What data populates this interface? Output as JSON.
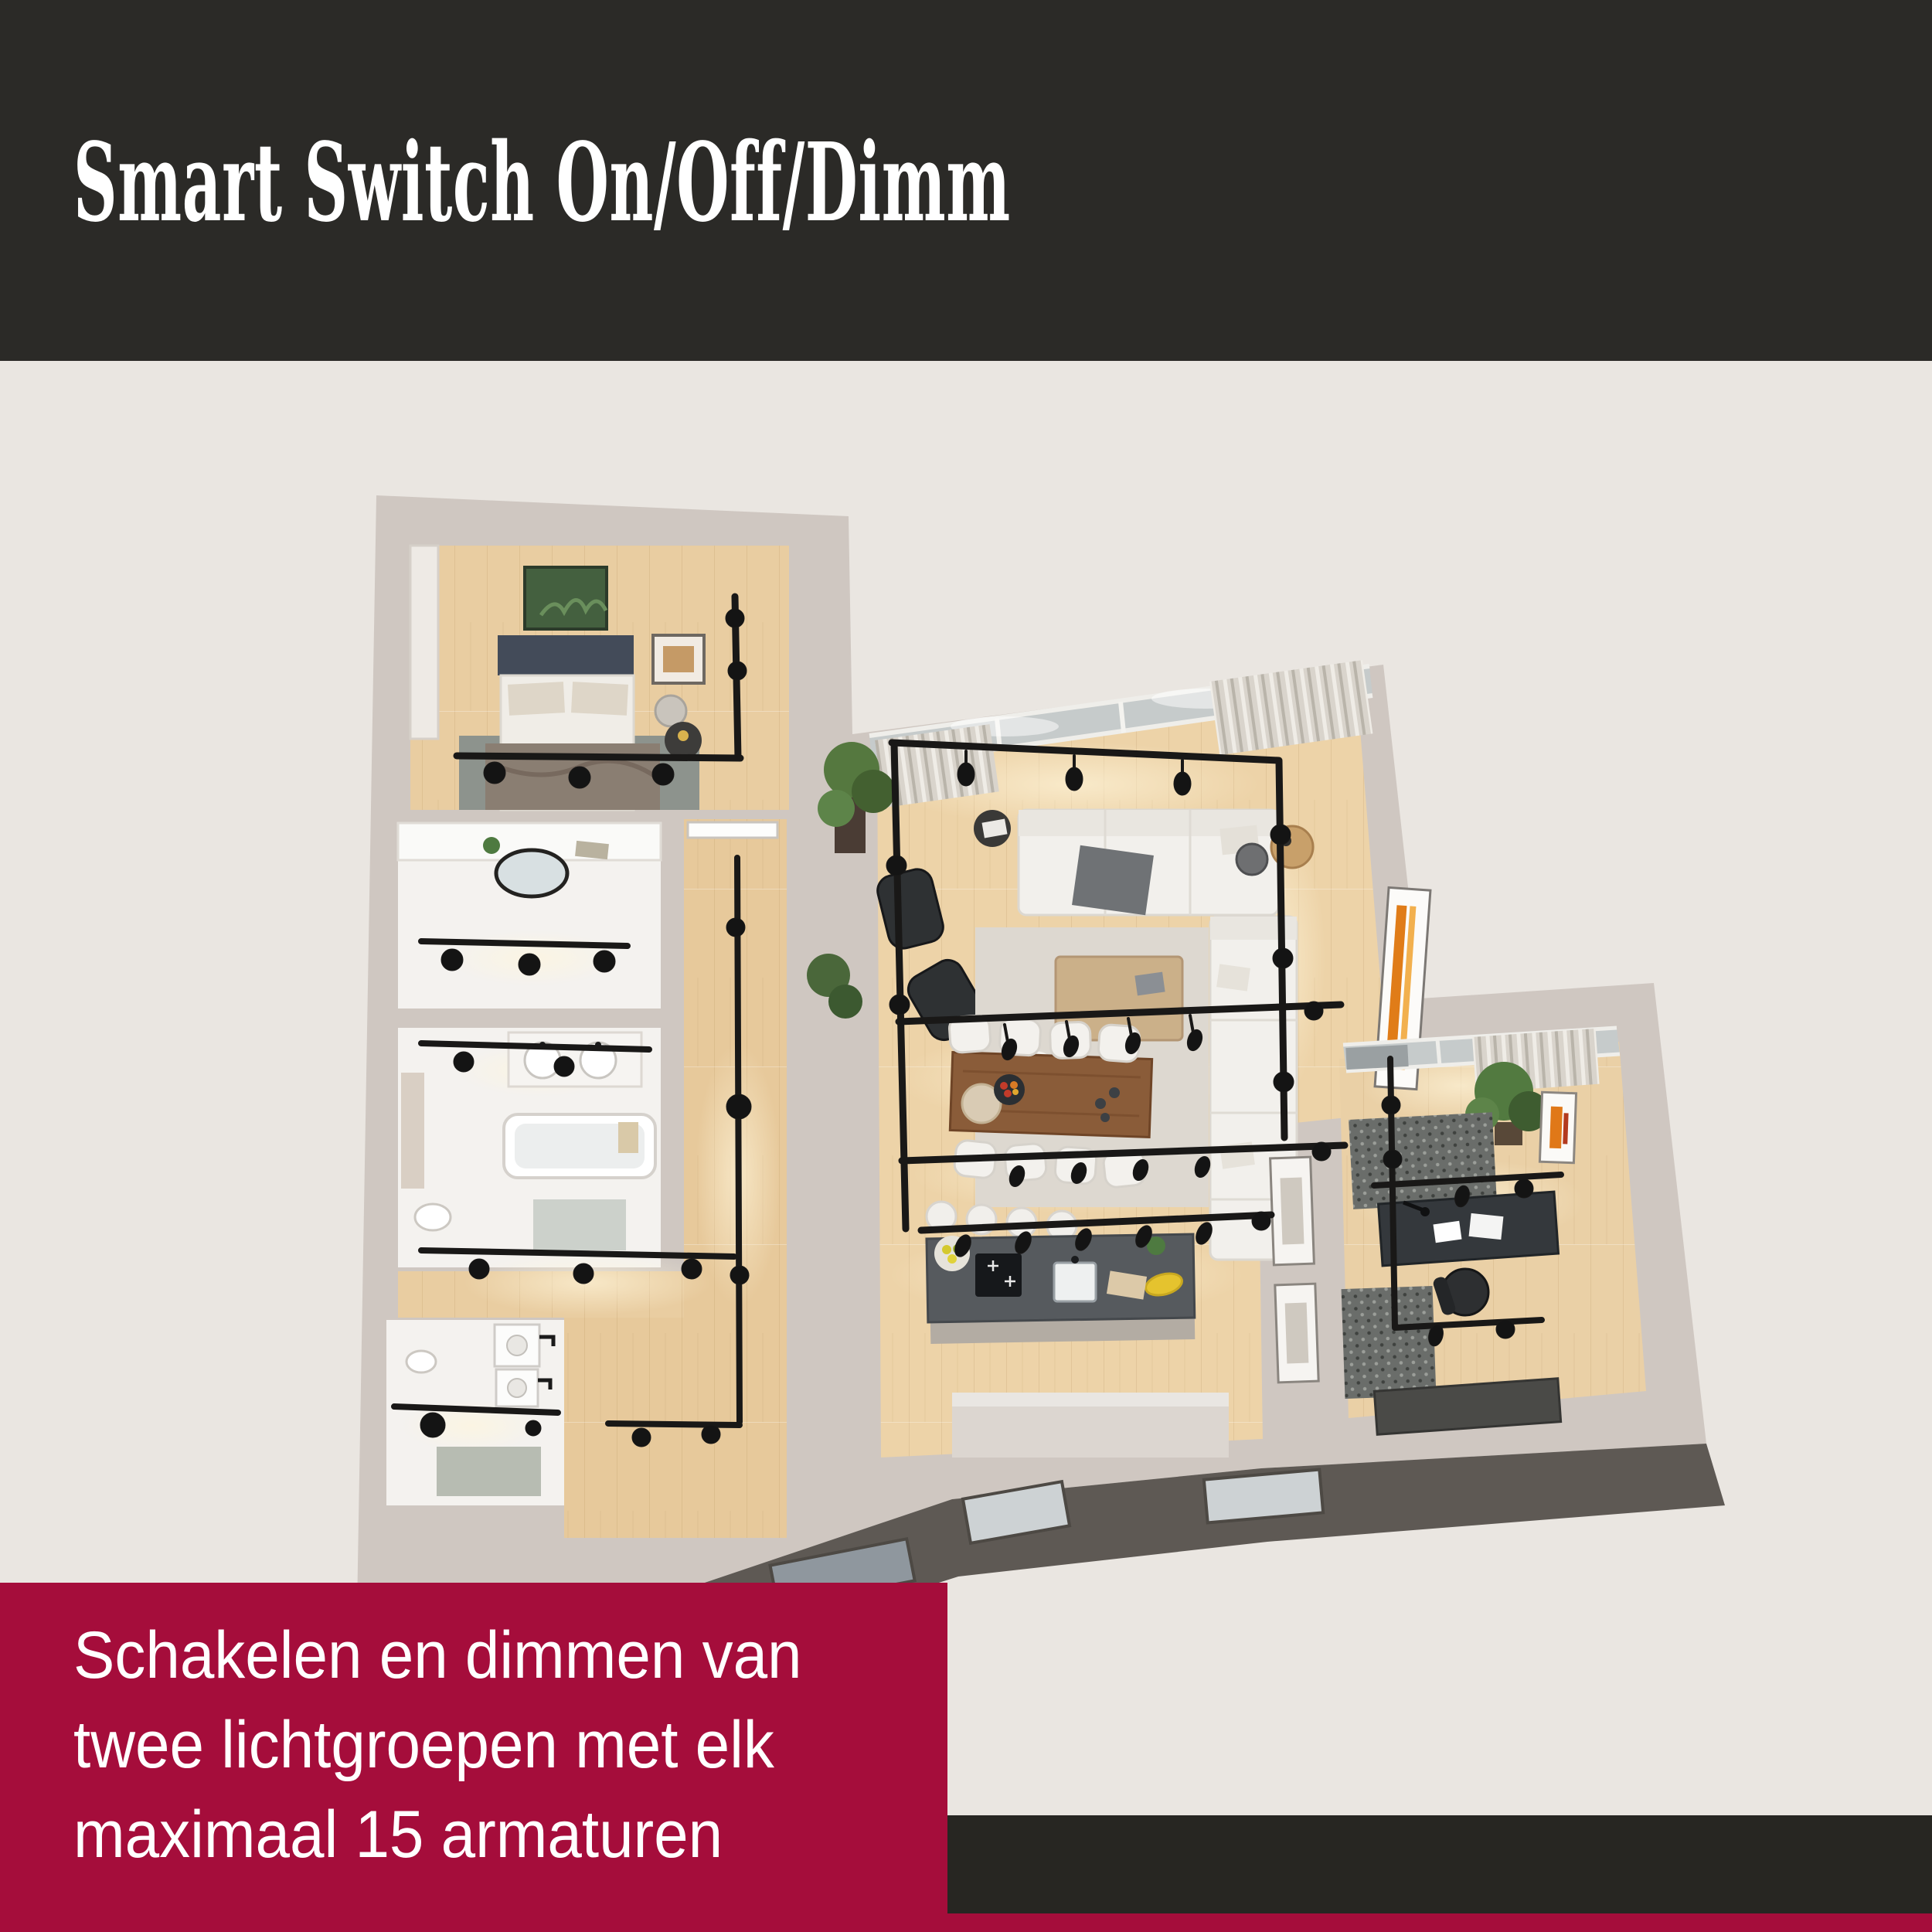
{
  "header": {
    "title": "Smart Switch On/Off/Dimm"
  },
  "caption": {
    "lines": [
      "Schakelen en dimmen van",
      "twee lichtgroepen met elk",
      "maximaal 15 armaturen"
    ]
  },
  "theme": {
    "header_bg": "#2b2a27",
    "body_bg": "#eae6e1",
    "banner_bg": "#a50d3b",
    "footer_bg": "#272622",
    "text_light": "#ffffff"
  },
  "floor_plan": {
    "type": "3d-isometric-apartment-render",
    "description": "Top-down 3D render of an apartment lit by black track lighting in every room",
    "palette": {
      "wall": "#cfc7c1",
      "wall_face": "#5e5954",
      "wood_floor": "#e9cda1",
      "tile_floor": "#f4f2ef",
      "track": "#191817",
      "sofa": "#f2f0ec",
      "dining_table": "#8a5c39",
      "kitchen_island": "#565a5e",
      "accent_art": "#e07818",
      "plant": "#527a40"
    },
    "rooms": [
      {
        "name": "bedroom",
        "furniture": [
          "double-bed",
          "area-rug",
          "plant-wall-art",
          "picture-frame",
          "nightstand",
          "wardrobe",
          "track-light"
        ]
      },
      {
        "name": "bathroom",
        "furniture": [
          "oval-mirror",
          "vanity",
          "track-light"
        ]
      },
      {
        "name": "bathroom-with-tub",
        "furniture": [
          "bathtub",
          "double-sink-vanity",
          "toilet",
          "bath-mat",
          "track-light"
        ]
      },
      {
        "name": "utility-room",
        "furniture": [
          "washer",
          "sink-units",
          "rug",
          "track-light"
        ]
      },
      {
        "name": "hallway",
        "furniture": [
          "door",
          "track-light"
        ]
      },
      {
        "name": "living-room",
        "furniture": [
          "glass-wall",
          "curtains",
          "sectional-sofa",
          "sofa",
          "lounge-chairs",
          "ottoman",
          "coffee-table",
          "area-rug",
          "accent-chair",
          "side-tables",
          "pendant-lamp",
          "plants",
          "striped-wall-art",
          "track-light-loop"
        ]
      },
      {
        "name": "dining-area",
        "furniture": [
          "wood-dining-table",
          "eight-white-chairs",
          "fruit-bowl",
          "serving-board",
          "track-light"
        ]
      },
      {
        "name": "kitchen",
        "furniture": [
          "island",
          "induction-cooktop",
          "sink",
          "bar-stools",
          "fruit-bowls",
          "cutting-board",
          "track-light"
        ]
      },
      {
        "name": "office",
        "furniture": [
          "window-wall",
          "curtains",
          "desk",
          "laptop",
          "office-chair",
          "patterned-rugs",
          "sideboard",
          "plant",
          "orange-wall-art",
          "track-light"
        ]
      }
    ]
  }
}
